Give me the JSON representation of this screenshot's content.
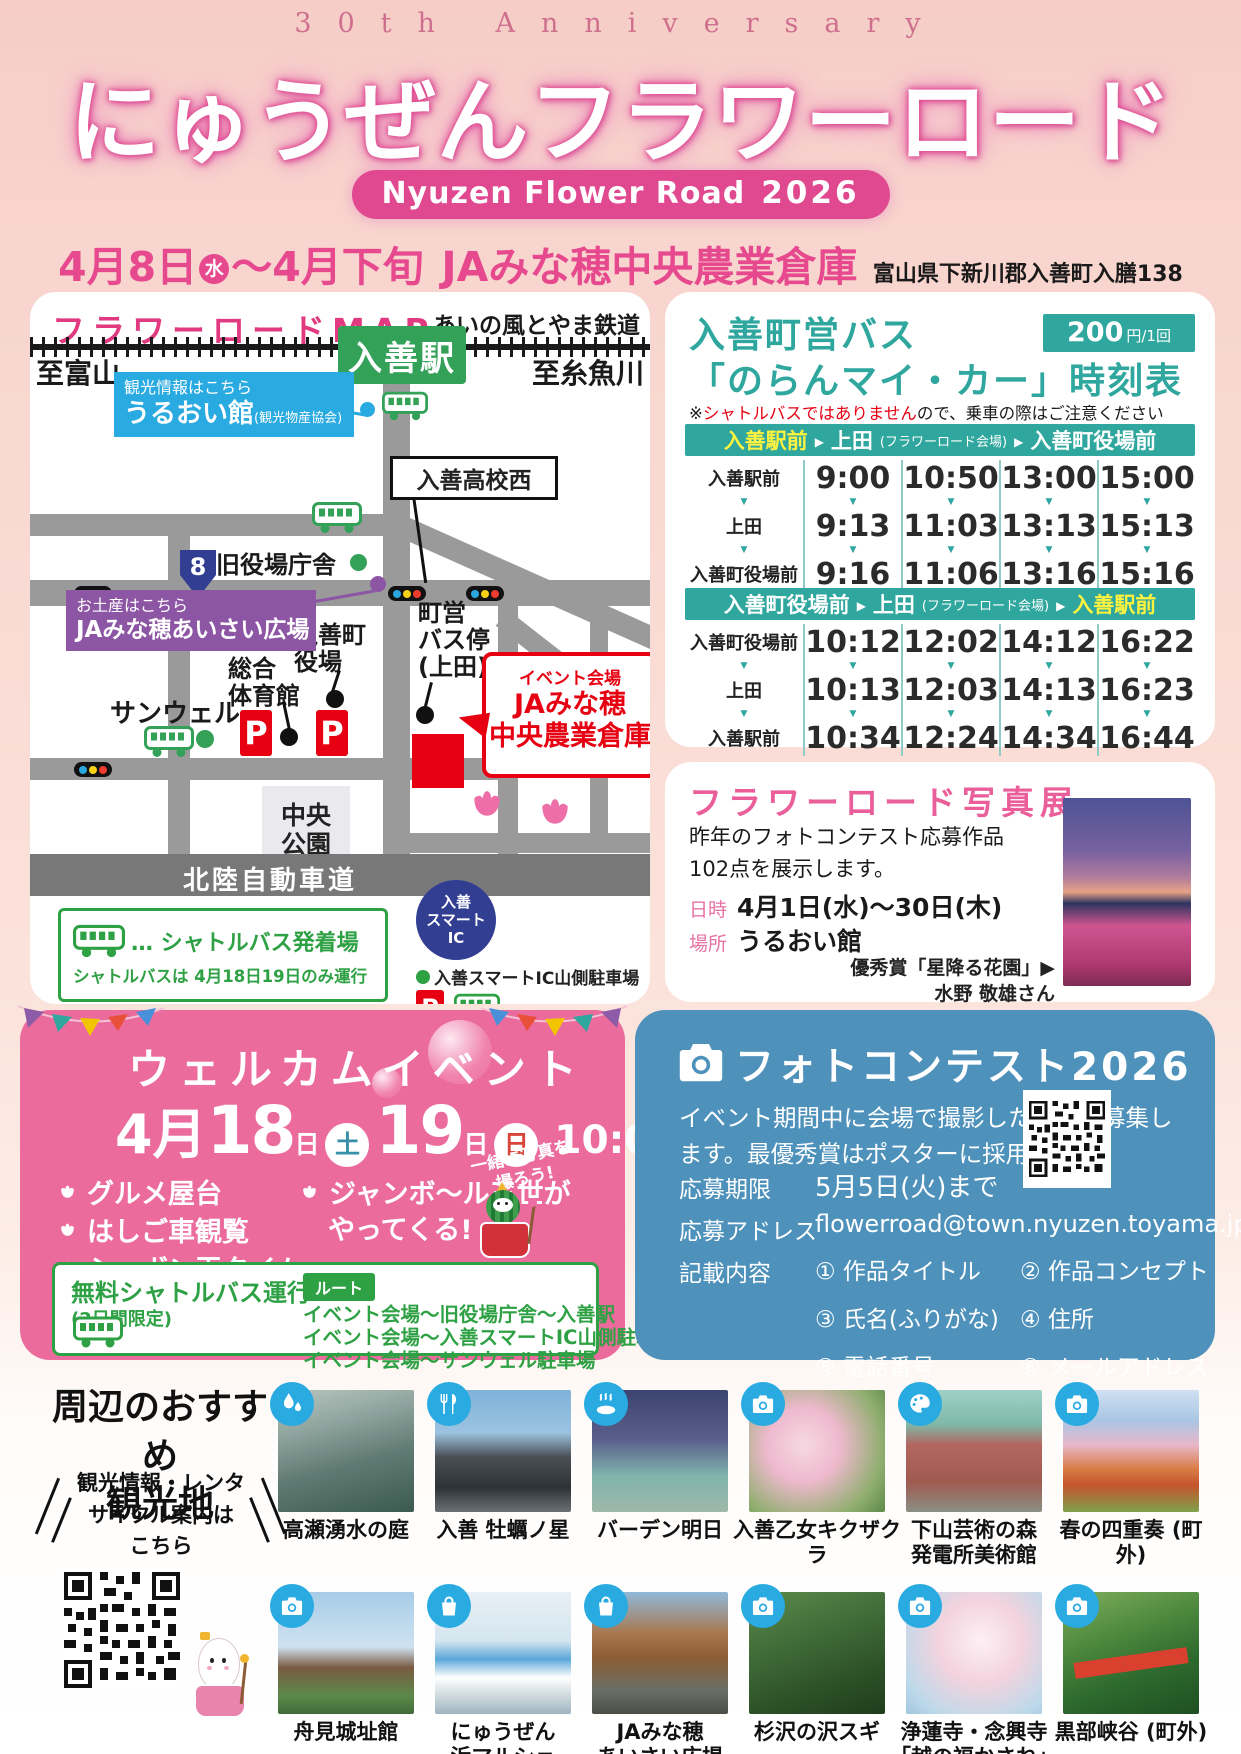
{
  "colors": {
    "accent_pink": "#e0498f",
    "date_pink": "#e7498f",
    "teal": "#2fa79e",
    "timetable_yellow": "#fff33f",
    "blue_card": "#4e92bc",
    "event_pink": "#ec6b9d",
    "green": "#2fa145",
    "map_green": "#33a157",
    "purple": "#8d56a4",
    "callout_blue": "#29aae1",
    "red": "#e60012",
    "navy": "#323e92",
    "icon_cyan": "#29abe2"
  },
  "header": {
    "anniversary": "30th Anniversary",
    "title": "にゅうぜんフラワーロード",
    "badge": "Nyuzen Flower Road",
    "badge_year": "2026",
    "date_start": "4月8日",
    "date_start_day": "水",
    "date_range": "〜4月下旬",
    "venue": "JAみな穂中央農業倉庫",
    "address": "富山県下新川郡入善町入膳138"
  },
  "map": {
    "title": "フラワーロードMAP",
    "railway": "あいの風とやま鉄道",
    "station": "入善駅",
    "to_left": "至富山",
    "to_right": "至糸魚川",
    "info_note": "観光情報はこちら",
    "info_name": "うるおい館",
    "info_sub": "(観光物産協会)",
    "old_hall": "旧役場庁舎",
    "school": "入善高校西",
    "route_no": "8",
    "souvenir_note": "お土産はこちら",
    "souvenir_name": "JAみな穂あいさい広場",
    "town_hall": "入善町\n役場",
    "gym": "総合\n体育館",
    "sunwell": "サンウェル",
    "bus_stop": "町営\nバス停\n(上田)",
    "venue_tag": "イベント会場",
    "venue_name": "JAみな穂\n中央農業倉庫",
    "park": "中央\n公園",
    "highway": "北陸自動車道",
    "ic": "入善\nスマート\nIC",
    "parking": "P",
    "legend_title": "… シャトルバス発着場",
    "legend_note": "シャトルバスは 4月18日19日のみ運行",
    "ic_parking": "入善スマートIC山側駐車場"
  },
  "timetable": {
    "title1": "入善町営バス",
    "title2": "「のらんマイ・カー」時刻表",
    "fare": "200",
    "fare_unit": "円/1回",
    "note_mark": "※",
    "note_red": "シャトルバスではありません",
    "note_rest": "ので、乗車の際はご注意ください",
    "dir1": {
      "from": "入善駅前",
      "via": "上田",
      "via_note": "(フラワーロード会場)",
      "to": "入善町役場前",
      "rows": [
        {
          "stop": "入善駅前",
          "times": [
            "9:00",
            "10:50",
            "13:00",
            "15:00"
          ]
        },
        {
          "stop": "上田",
          "times": [
            "9:13",
            "11:03",
            "13:13",
            "15:13"
          ]
        },
        {
          "stop": "入善町役場前",
          "times": [
            "9:16",
            "11:06",
            "13:16",
            "15:16"
          ]
        }
      ]
    },
    "dir2": {
      "from": "入善町役場前",
      "via": "上田",
      "via_note": "(フラワーロード会場)",
      "to": "入善駅前",
      "rows": [
        {
          "stop": "入善町役場前",
          "times": [
            "10:12",
            "12:02",
            "14:12",
            "16:22"
          ]
        },
        {
          "stop": "上田",
          "times": [
            "10:13",
            "12:03",
            "14:13",
            "16:23"
          ]
        },
        {
          "stop": "入善駅前",
          "times": [
            "10:34",
            "12:24",
            "14:34",
            "16:44"
          ]
        }
      ]
    }
  },
  "exhibition": {
    "title": "フラワーロード写真展",
    "desc": "昨年のフォトコンテスト応募作品\n102点を展示します。",
    "date_label": "日時",
    "date": "4月1日(水)〜30日(木)",
    "place_label": "場所",
    "place": "うるおい館",
    "award": "優秀賞「星降る花園」▶\n水野 敬雄さん"
  },
  "event": {
    "title": "ウェルカムイベント",
    "month": "4月",
    "day1": "18",
    "day1_suffix": "日",
    "day1_dow": "土",
    "day2": "19",
    "day2_suffix": "日",
    "day2_dow": "日",
    "time": "10:00〜16:00",
    "items": [
      "グルメ屋台",
      "はしご車観覧",
      "シャボン玉タイム"
    ],
    "guest_line1": "ジャンボ〜ル三世が",
    "guest_line2": "やってくる!",
    "photo_note": "一緒に写真を\n撮ろう!",
    "shuttle_title": "無料シャトルバス運行",
    "shuttle_sub": "(2日間限定)",
    "route_label": "ルート",
    "routes": [
      "イベント会場〜旧役場庁舎〜入善駅",
      "イベント会場〜入善スマートIC山側駐車場",
      "イベント会場〜サンウェル駐車場"
    ]
  },
  "contest": {
    "title": "フォトコンテスト2026",
    "desc": "イベント期間中に会場で撮影した写真を募集し\nます。最優秀賞はポスターに採用します。",
    "deadline_label": "応募期限",
    "deadline": "5月5日(火)まで",
    "address_label": "応募アドレス",
    "address": "flowerroad@town.nyuzen.toyama.jp",
    "content_label": "記載内容",
    "items": [
      "① 作品タイトル",
      "② 作品コンセプト",
      "③ 氏名(ふりがな)",
      "④ 住所",
      "⑤ 電話番号",
      "⑥ メールアドレス"
    ]
  },
  "attractions": {
    "heading": "周辺のおすすめ\n観光地",
    "qr_note": "観光情報・レンタ\nサイクル案内は\nこちら",
    "row1": [
      {
        "name": "高瀬湧水の庭",
        "icon": "water-icon"
      },
      {
        "name": "入善 牡蠣ノ星",
        "icon": "restaurant-icon"
      },
      {
        "name": "バーデン明日",
        "icon": "onsen-icon"
      },
      {
        "name": "入善乙女キクザクラ",
        "icon": "camera-icon"
      },
      {
        "name": "下山芸術の森\n発電所美術館",
        "icon": "palette-icon"
      },
      {
        "name": "春の四重奏 (町外)",
        "icon": "camera-icon"
      }
    ],
    "row2": [
      {
        "name": "舟見城址館",
        "icon": "camera-icon"
      },
      {
        "name": "にゅうぜん\n浜マルシェ",
        "icon": "bag-icon"
      },
      {
        "name": "JAみな穂\nあいさい広場",
        "icon": "bag-icon"
      },
      {
        "name": "杉沢の沢スギ",
        "icon": "camera-icon"
      },
      {
        "name": "浄蓮寺・念興寺\n「越の福かさね」",
        "icon": "camera-icon"
      },
      {
        "name": "黒部峡谷 (町外)",
        "icon": "camera-icon"
      }
    ]
  }
}
